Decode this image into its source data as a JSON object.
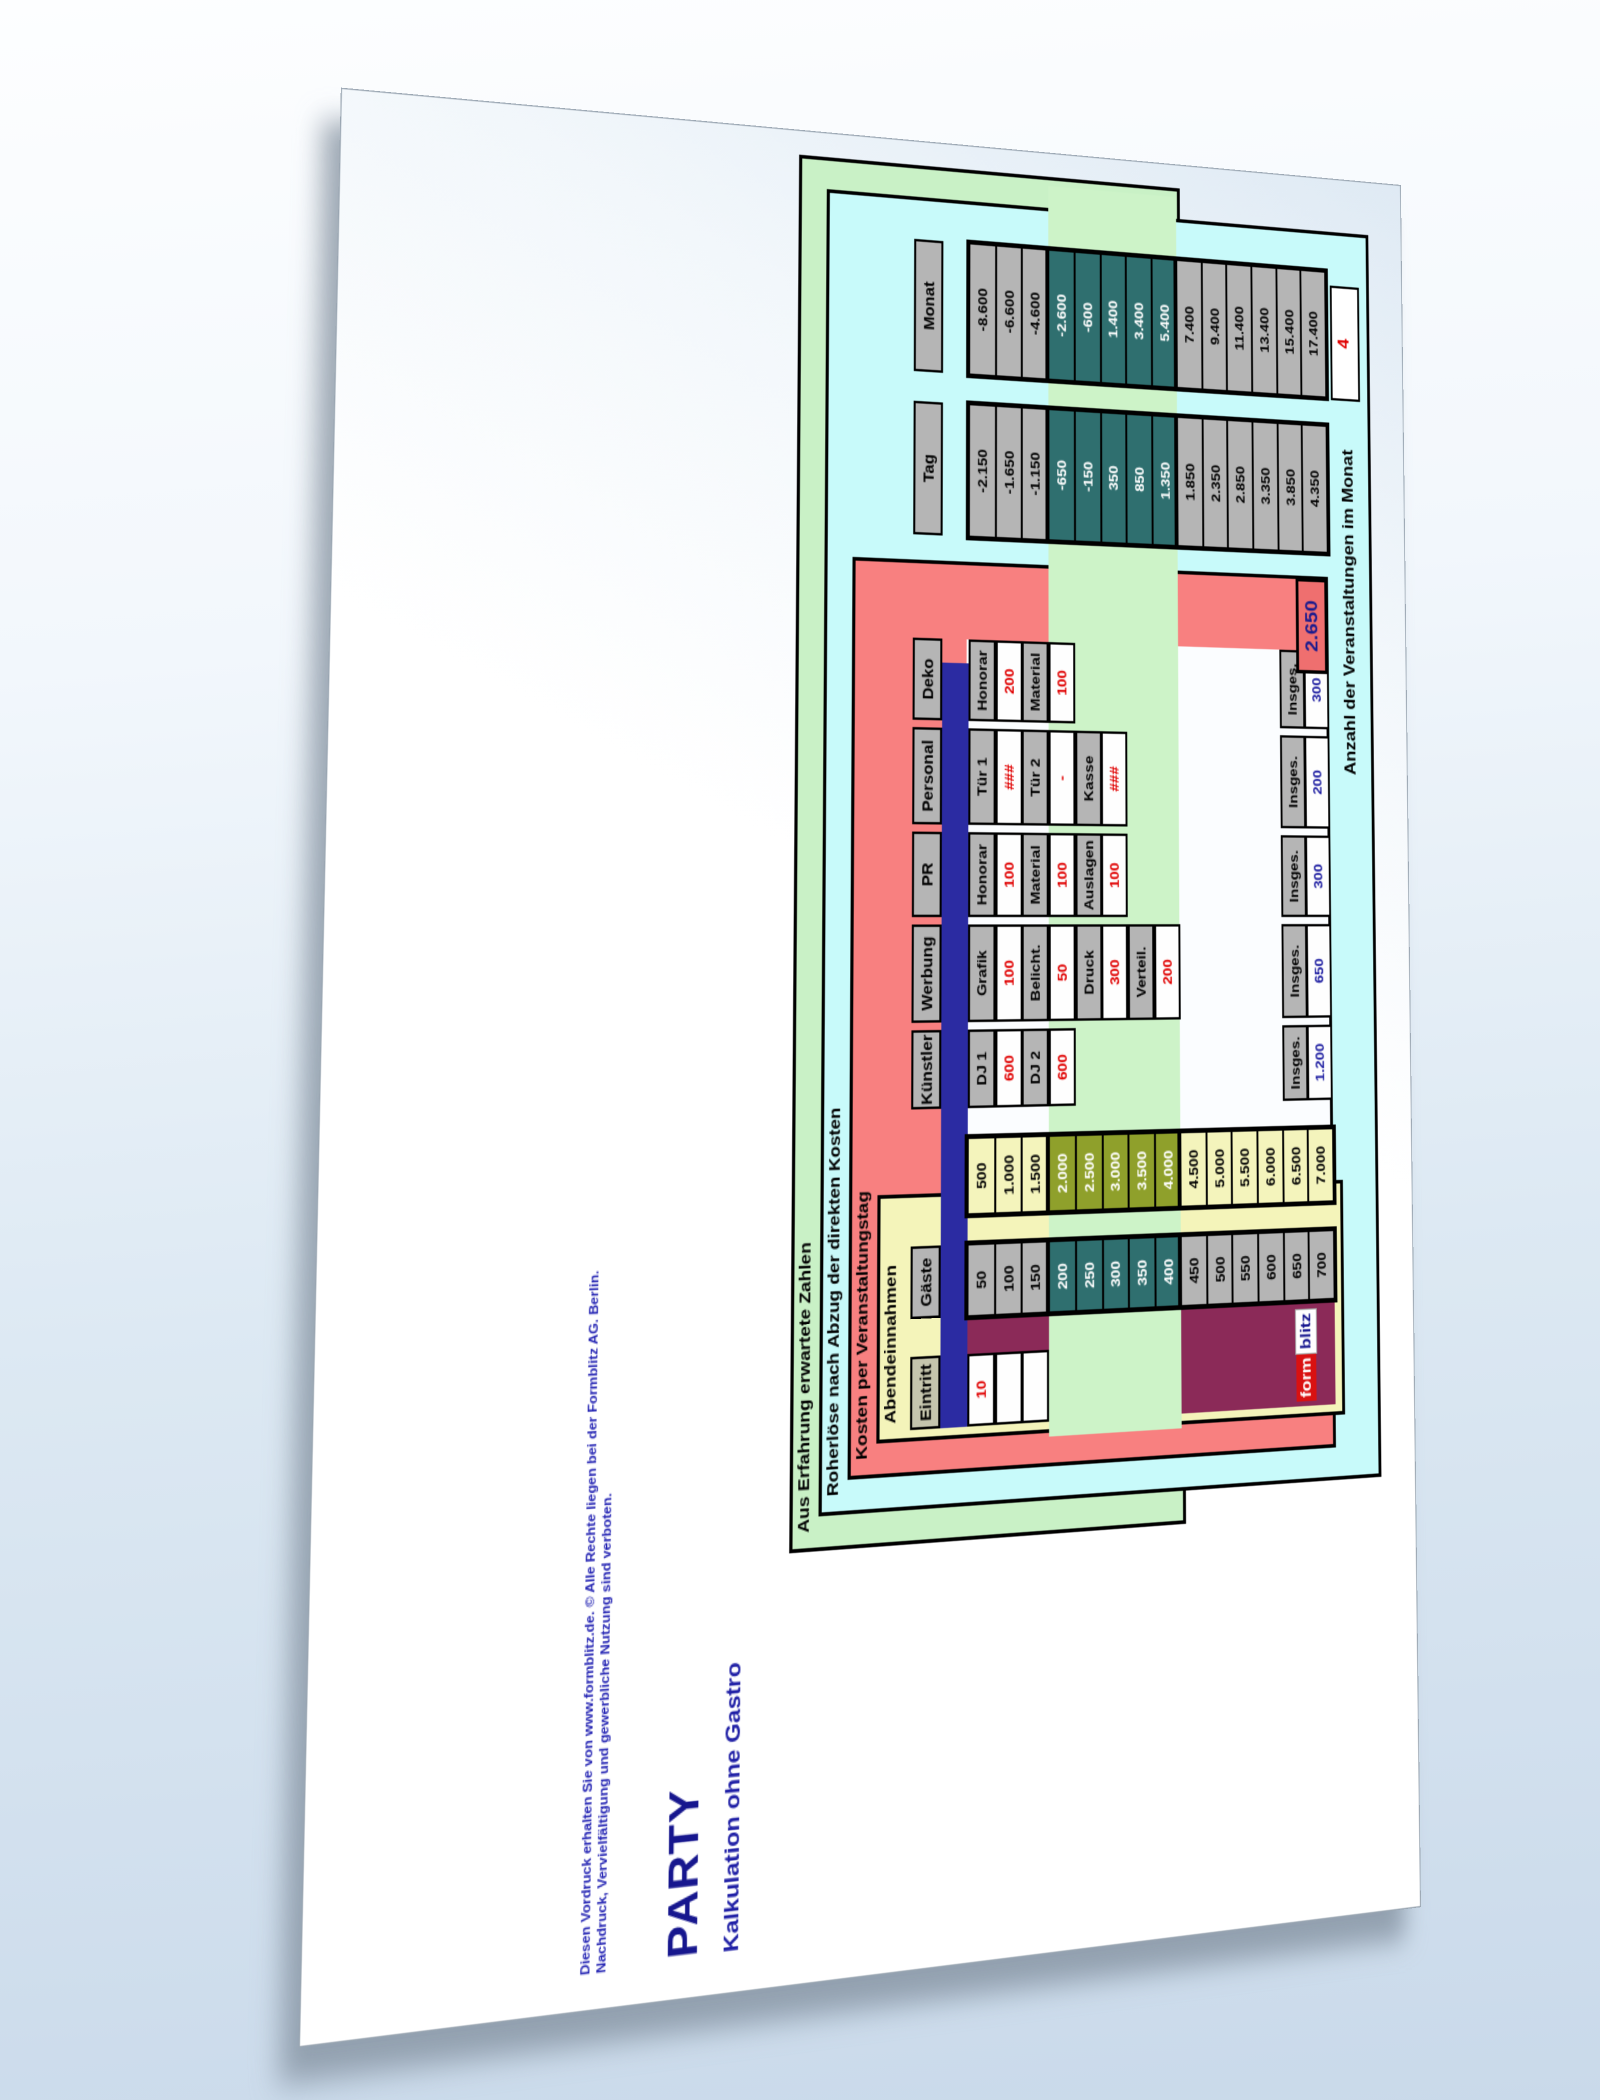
{
  "page": {
    "copyright_line1": "Diesen Vordruck erhalten Sie von www.formblitz.de. © Alle Rechte liegen bei der Formblitz AG. Berlin.",
    "copyright_line2": "Nachdruck, Vervielfältigung und gewerbliche Nutzung sind verboten.",
    "title": "PARTY",
    "subtitle": "Kalkulation ohne Gastro"
  },
  "legend": {
    "erfahrung": "Aus Erfahrung erwartete Zahlen",
    "roherloese": "Roherlöse nach Abzug der direkten Kosten",
    "kosten": "Kosten per Veranstaltungstag",
    "abendeinnahmen": "Abendeinnahmen"
  },
  "colors": {
    "value_red": "#e00000",
    "insges_blue": "#2020a2",
    "band_green": "#cdf3c8",
    "box_cyan": "#c8fafa",
    "box_salmon": "#f88080",
    "box_yellow": "#f4f4ba",
    "highlight_teal": "#2f6f6f",
    "highlight_olive": "#8fa02b",
    "navy_separator": "#2b2ba2",
    "maroon_block": "#8b2a58"
  },
  "grid": {
    "eintritt": {
      "header": "Eintritt",
      "value": "10"
    },
    "gaeste": {
      "header": "Gäste",
      "values": [
        "50",
        "100",
        "150",
        "200",
        "250",
        "300",
        "350",
        "400",
        "450",
        "500",
        "550",
        "600",
        "650",
        "700"
      ]
    },
    "einnahmen": {
      "values": [
        "500",
        "1.000",
        "1.500",
        "2.000",
        "2.500",
        "3.000",
        "3.500",
        "4.000",
        "4.500",
        "5.000",
        "5.500",
        "6.000",
        "6.500",
        "7.000"
      ]
    },
    "cost_columns": [
      {
        "header": "Künstler",
        "rows": [
          {
            "label": "DJ 1",
            "value": "600"
          },
          {
            "label": "DJ 2",
            "value": "600"
          }
        ],
        "insges_label": "Insges.",
        "insges_value": "1.200"
      },
      {
        "header": "Werbung",
        "rows": [
          {
            "label": "Grafik",
            "value": "100"
          },
          {
            "label": "Belicht.",
            "value": "50"
          },
          {
            "label": "Druck",
            "value": "300"
          },
          {
            "label": "Verteil.",
            "value": "200"
          }
        ],
        "insges_label": "Insges.",
        "insges_value": "650"
      },
      {
        "header": "PR",
        "rows": [
          {
            "label": "Honorar",
            "value": "100"
          },
          {
            "label": "Material",
            "value": "100"
          },
          {
            "label": "Auslagen",
            "value": "100"
          }
        ],
        "insges_label": "Insges.",
        "insges_value": "300"
      },
      {
        "header": "Personal",
        "rows": [
          {
            "label": "Tür 1",
            "value": "###"
          },
          {
            "label": "Tür 2",
            "value": "-"
          },
          {
            "label": "Kasse",
            "value": "###"
          }
        ],
        "insges_label": "Insges.",
        "insges_value": "200"
      },
      {
        "header": "Deko",
        "rows": [
          {
            "label": "Honorar",
            "value": "200"
          },
          {
            "label": "Material",
            "value": "100"
          }
        ],
        "insges_label": "Insges.",
        "insges_value": "300"
      }
    ],
    "kosten_total": "2.650",
    "tag": {
      "header": "Tag",
      "values": [
        "-2.150",
        "-1.650",
        "-1.150",
        "-650",
        "-150",
        "350",
        "850",
        "1.350",
        "1.850",
        "2.350",
        "2.850",
        "3.350",
        "3.850",
        "4.350"
      ]
    },
    "monat": {
      "header": "Monat",
      "values": [
        "-8.600",
        "-6.600",
        "-4.600",
        "-2.600",
        "-600",
        "1.400",
        "3.400",
        "5.400",
        "7.400",
        "9.400",
        "11.400",
        "13.400",
        "15.400",
        "17.400"
      ]
    },
    "anzahl": {
      "label": "Anzahl der Veranstaltungen im Monat",
      "value": "4"
    }
  },
  "logo": {
    "part1": "form",
    "part2": "blitz"
  }
}
